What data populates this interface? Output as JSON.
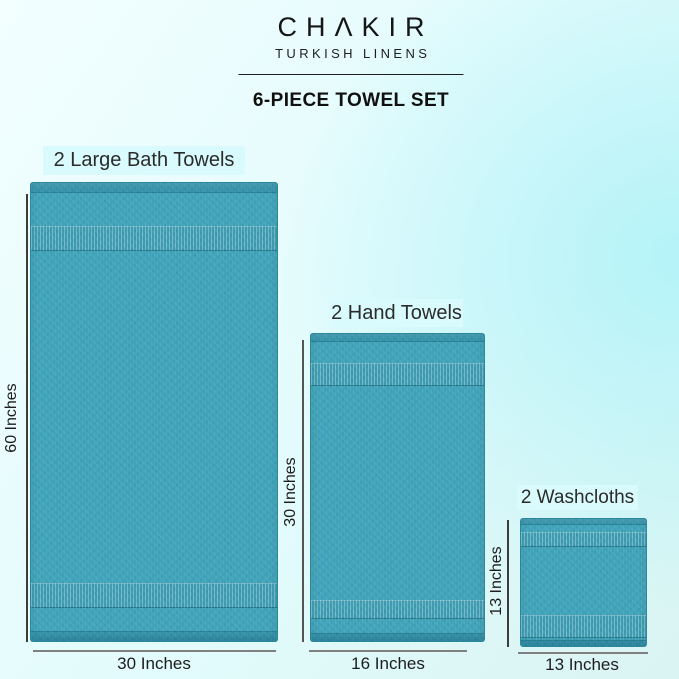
{
  "header": {
    "brand_display": "CHΛKIR",
    "brand_name": "CHAKIR",
    "brand_subtitle": "TURKISH LINENS",
    "product_title": "6-PIECE TOWEL SET"
  },
  "items": [
    {
      "name": "large-bath-towels",
      "label": "2 Large Bath Towels",
      "quantity": 2,
      "height_label": "60 Inches",
      "width_label": "30 Inches",
      "height_inches": 60,
      "width_inches": 30
    },
    {
      "name": "hand-towels",
      "label": "2 Hand Towels",
      "quantity": 2,
      "height_label": "30 Inches",
      "width_label": "16 Inches",
      "height_inches": 30,
      "width_inches": 16
    },
    {
      "name": "washcloths",
      "label": "2 Washcloths",
      "quantity": 2,
      "height_label": "13 Inches",
      "width_label": "13 Inches",
      "height_inches": 13,
      "width_inches": 13
    }
  ],
  "colors": {
    "towel": "#3fa3b9",
    "towel_border": "#2b8ea5",
    "label_background": "#d9fbfd",
    "background_light": "#f2feff",
    "background_cyan": "#b4f3f8",
    "dimension_line": "#555555",
    "text": "#1d1d1d"
  }
}
